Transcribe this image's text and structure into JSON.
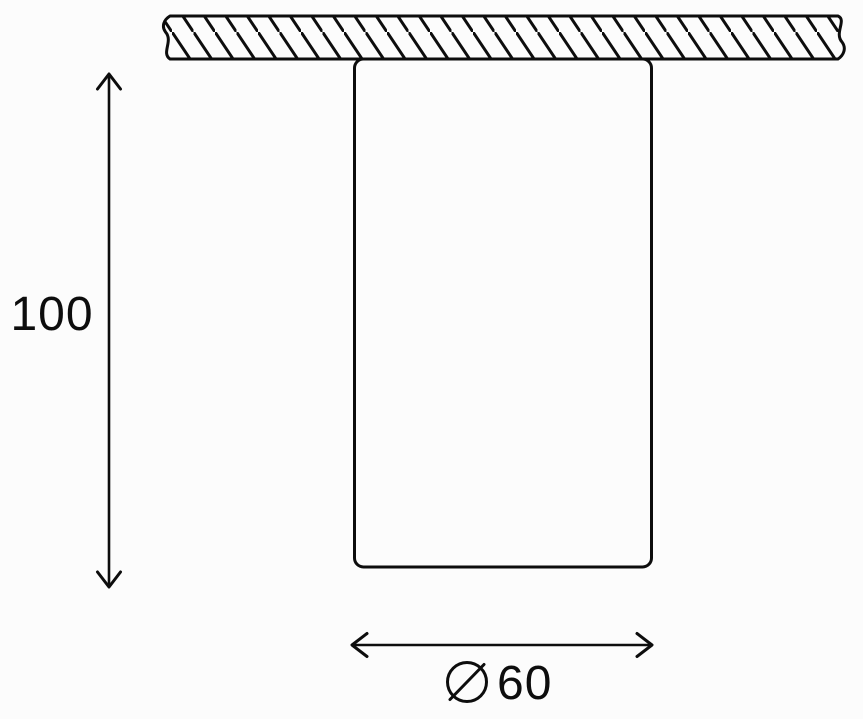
{
  "drawing": {
    "description": "Dimensioned side-view technical line drawing of a ceiling-mounted cylindrical fixture",
    "background_color": "#fcfcfc",
    "line_color": "#0d0d0d",
    "mounting_surface": {
      "style": "diagonal-hatch",
      "hatch_direction": "top-left-to-bottom-right",
      "broken_ends": true
    },
    "body": {
      "shape": "rounded-rectangle"
    },
    "dimensions": {
      "height": {
        "label": "100",
        "orientation": "vertical"
      },
      "diameter": {
        "label": "⌀60",
        "symbol": "⌀",
        "number": "60",
        "orientation": "horizontal"
      }
    }
  }
}
